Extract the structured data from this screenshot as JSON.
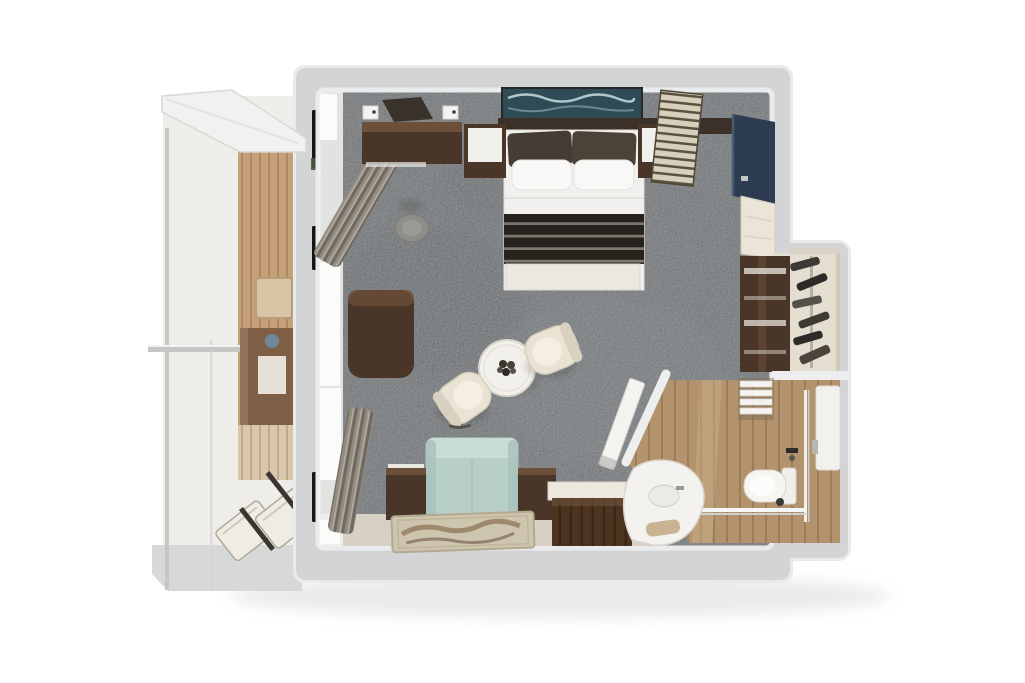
{
  "scene": {
    "title": "3D floor plan render - suite with balcony",
    "view": "top-down-3d",
    "canvas_width": "1025",
    "canvas_height": "683"
  },
  "palette": {
    "bg": "#ffffff",
    "wallRim": "#e8eaeb",
    "wall": "#d2d4d6",
    "wallInner": "#eceeef",
    "carpet": "#75787a",
    "carpetPatchLight": "#828587",
    "carpetPatchDark": "#686b6d",
    "balconyFloor": "#efede9",
    "deck": "#d7d8d8",
    "overhang": "#f1f1ef",
    "rail": "#c6c6c4",
    "bronzeGlass": "#7f5f46",
    "lampWhite": "#efece6",
    "lampBlue": "#6d8da1",
    "balconyTable": "#d8c5a6",
    "loungerCream": "#efece3",
    "furnWood": "#4a3628",
    "furnWoodDark": "#33241a",
    "furnWoodLight": "#6b4f38",
    "charcoalShelf": "#3a332c",
    "headboard": "#3c3129",
    "artTeal": "#2f4c56",
    "pillowDark": "#463c33",
    "pillowDark2": "#4c4238",
    "bedWhite": "#f1f0ee",
    "bench": "#ebe8e2",
    "stool": "#8e8d8a",
    "navyPanel": "#2d3c50",
    "doorCream": "#ebe5d7",
    "sofa": "#b8cfc9",
    "sofaLight": "#cadcd6",
    "chairCream": "#eae3d3",
    "tableWhite": "#f2f0ea",
    "rug": "#cec5af",
    "floorBand": "#d7d1c5",
    "minibarTop": "#ece8de",
    "closetFloor": "#e3decf",
    "clothesDark": "#3e3935",
    "fixtureWhite": "#f6f5f2",
    "towel": "#c9b392",
    "windowGlow": "#fbfbfa",
    "windowSlit": "#161616",
    "greenSpeck": "#49543f"
  },
  "rooms": [
    {
      "name": "balcony",
      "items": [
        "glass-railing",
        "privacy-divider-handrail",
        "wood-wall",
        "sliding-glass-door",
        "balcony-side-table",
        "sun-lounger",
        "sun-lounger",
        "deck-edge",
        "overhang"
      ]
    },
    {
      "name": "bedroom-living",
      "items": [
        "double-bed",
        "headboard-artwork",
        "dark-pillows",
        "white-pillows",
        "foot-runner",
        "foot-bench",
        "nightstand-left",
        "nightstand-right",
        "dresser-console",
        "wall-shelf",
        "wall-lights",
        "ottoman",
        "desk",
        "curtain-top",
        "curtain-bottom",
        "round-table",
        "swivel-chair",
        "swivel-chair",
        "sofa",
        "side-table-left",
        "side-table-right",
        "area-rug",
        "minibar-cabinet",
        "slatted-screen",
        "tv-panel",
        "entry-door",
        "mirror-wardrobe"
      ]
    },
    {
      "name": "walk-in-closet",
      "items": [
        "clothes-rail",
        "hanging-clothes",
        "closet-shelf"
      ]
    },
    {
      "name": "bathroom",
      "items": [
        "bathroom-door",
        "vanity-counter",
        "sink",
        "towel",
        "toilet",
        "shower-glass",
        "shower-panel",
        "shower-fixture",
        "towel-ladder"
      ]
    }
  ]
}
